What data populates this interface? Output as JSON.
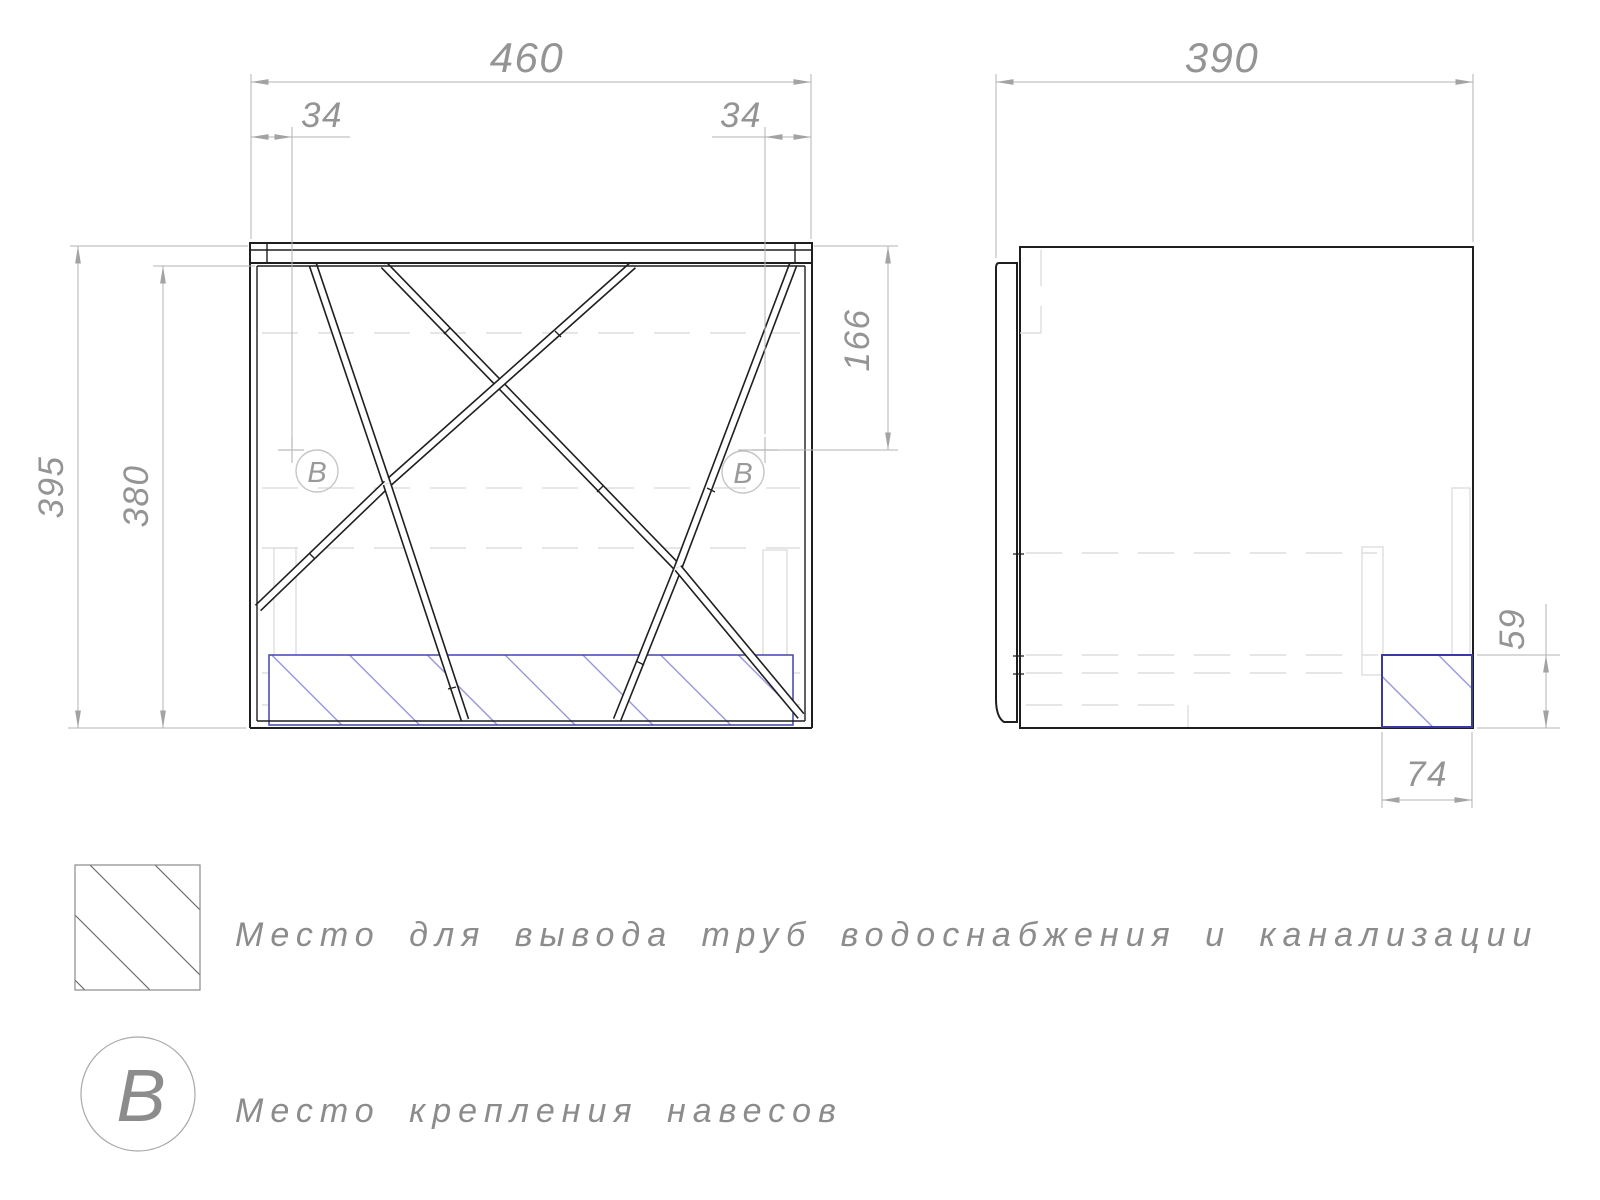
{
  "front_view": {
    "dim_width": "460",
    "dim_offset_left": "34",
    "dim_offset_right": "34",
    "dim_height_outer": "395",
    "dim_height_inner": "380",
    "dim_mount_height": "166",
    "marker_left": "B",
    "marker_right": "B"
  },
  "side_view": {
    "dim_depth": "390",
    "dim_cutout_height": "59",
    "dim_cutout_width": "74"
  },
  "legend": {
    "hatch_label": "Место для вывода труб водоснабжения и канализации",
    "marker_symbol": "B",
    "marker_label": "Место крепления навесов"
  },
  "colors": {
    "line": "#1f1f1f",
    "dimension_text": "#949494",
    "dimension_line": "#b3b3b3",
    "hidden_detail": "#d8d8d8",
    "cutout_border": "#4343b0",
    "cutout_hatch": "#8d8dd8"
  }
}
